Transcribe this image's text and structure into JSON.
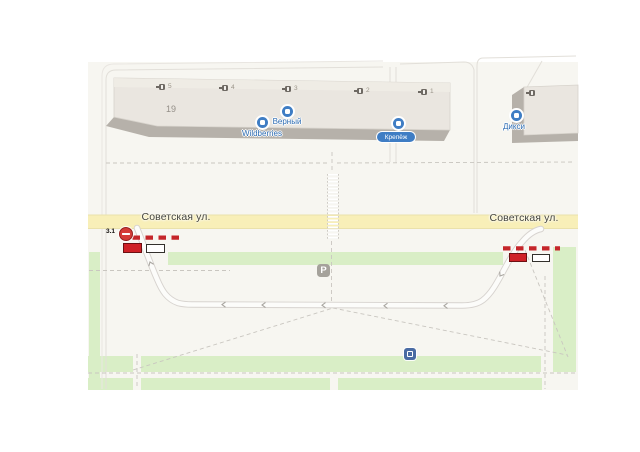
{
  "map": {
    "street": {
      "label_left": "Советская ул.",
      "label_right": "Советская ул."
    },
    "closure": {
      "sign_code": "3.1"
    },
    "building_main": {
      "number": "19",
      "entrances": [
        "5",
        "4",
        "3",
        "2",
        "1"
      ]
    },
    "pois": {
      "wildberries": {
        "label": "Wildberries"
      },
      "verny": {
        "label": "Верный"
      },
      "krepezh": {
        "label": "Крепёж",
        "selected": true
      },
      "diksi": {
        "label": "Дикси"
      }
    },
    "parking": {
      "label": "P"
    },
    "colors": {
      "road_yellow": "#f8efb8",
      "greenery": "#d9eec6",
      "closure_red": "#c5262a",
      "poi_blue": "#3f7dc4",
      "building": "#eae6e0",
      "land": "#f7f6f1"
    }
  }
}
